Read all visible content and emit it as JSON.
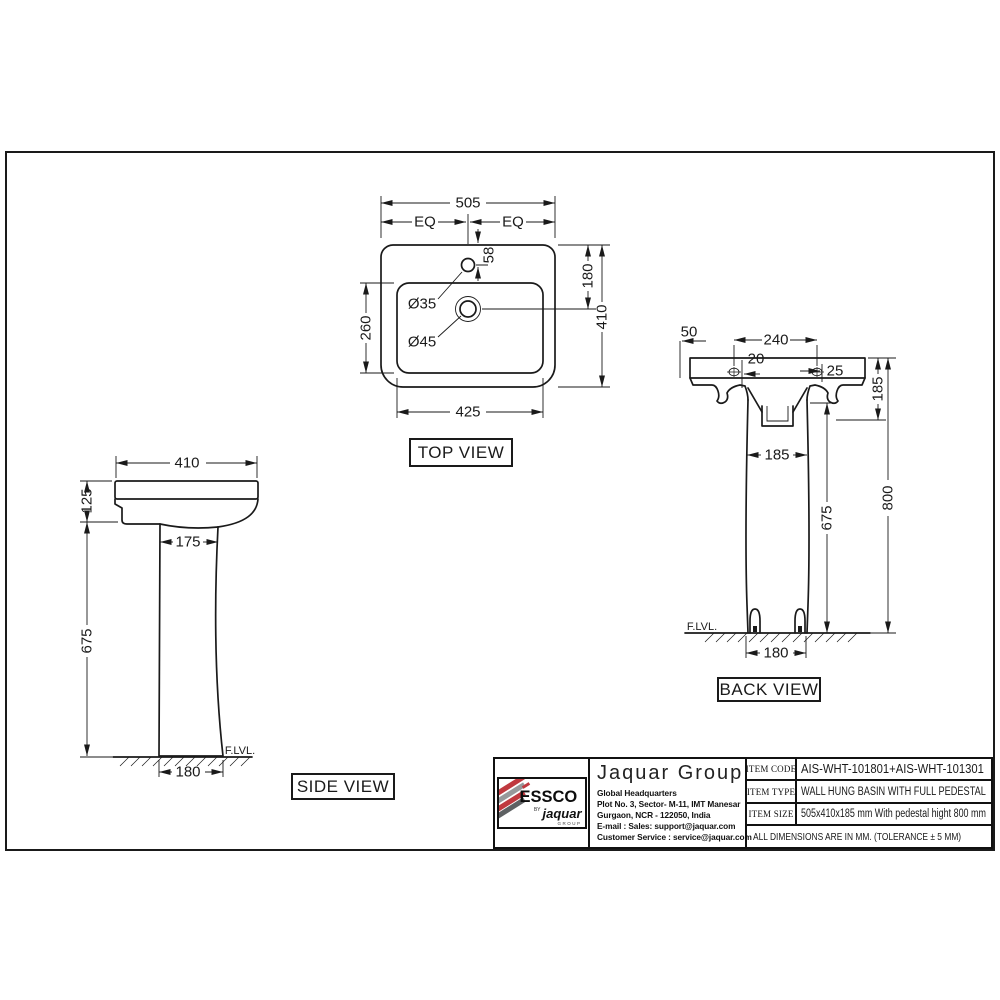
{
  "page": {
    "background": "#ffffff",
    "line_color": "#1a1a1a"
  },
  "views": {
    "top": {
      "label": "TOP VIEW",
      "dims": {
        "overall_width": "505",
        "eq_left": "EQ",
        "eq_right": "EQ",
        "tap_hole_offset": "58",
        "tap_depth": "180",
        "overall_depth": "410",
        "bowl_depth": "260",
        "tap_hole_dia": "Ø35",
        "drain_hole_dia": "Ø45",
        "bowl_width": "425"
      }
    },
    "side": {
      "label": "SIDE VIEW",
      "floor_label": "F.LVL.",
      "dims": {
        "overall_width": "410",
        "basin_height": "125",
        "pedestal_top_width": "175",
        "pedestal_height": "675",
        "base_width": "180"
      }
    },
    "back": {
      "label": "BACK VIEW",
      "floor_label": "F.LVL.",
      "dims": {
        "edge_offset": "50",
        "hole_spacing": "240",
        "hole_offset_left": "20",
        "hole_offset_right": "25",
        "basin_height": "185",
        "pedestal_width": "185",
        "pedestal_height": "675",
        "overall_height": "800",
        "base_width": "180"
      }
    }
  },
  "title_block": {
    "logo": {
      "brand": "ESSCO",
      "by": "BY",
      "sub_brand": "jaquar",
      "sub_brand_small": "GROUP",
      "red": "#c0393f",
      "gray": "#97999b",
      "dark": "#5e6163"
    },
    "company": {
      "name": "Jaquar Group",
      "address_lines": [
        "Global Headquarters",
        "Plot No. 3, Sector- M-11, IMT Manesar",
        "Gurgaon, NCR - 122050, India",
        "E-mail : Sales: support@jaquar.com",
        "Customer Service : service@jaquar.com"
      ]
    },
    "items": [
      {
        "label": "ITEM CODE",
        "value": "AIS-WHT-101801+AIS-WHT-101301"
      },
      {
        "label": "ITEM TYPE",
        "value": "WALL HUNG BASIN WITH FULL PEDESTAL"
      },
      {
        "label": "ITEM SIZE",
        "value": "505x410x185 mm With pedestal hight 800 mm"
      }
    ],
    "note": "ALL DIMENSIONS ARE IN MM. (TOLERANCE ± 5 MM)"
  }
}
